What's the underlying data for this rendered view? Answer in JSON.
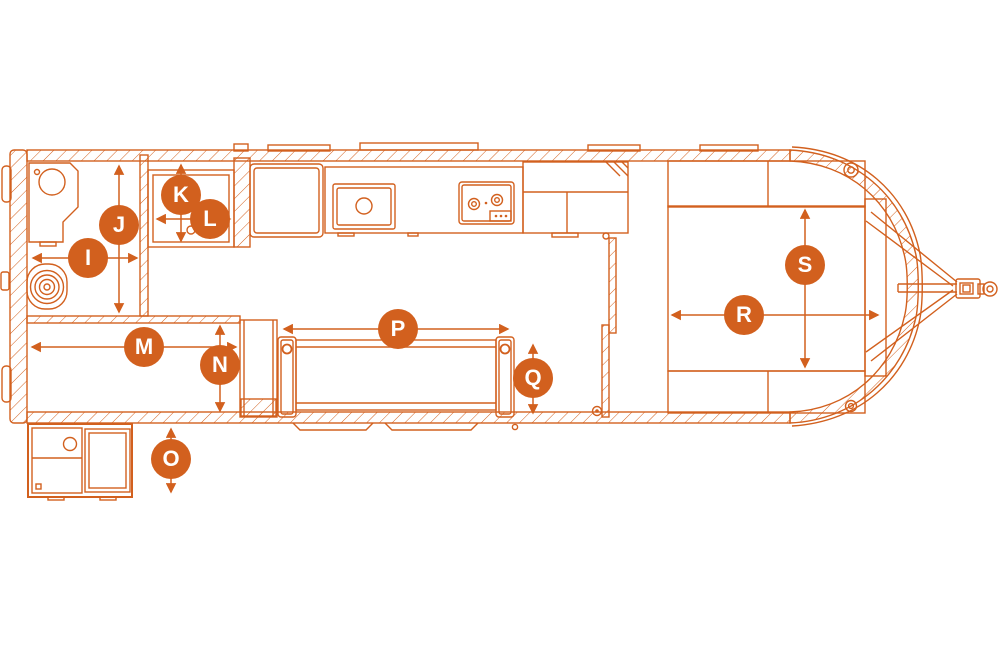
{
  "colors": {
    "accent": "#d2601e",
    "background": "#ffffff",
    "marker_letter": "#ffffff"
  },
  "markers": [
    {
      "letter": "I",
      "region": "bathroom",
      "orientation": "horizontal"
    },
    {
      "letter": "J",
      "region": "bathroom",
      "orientation": "vertical"
    },
    {
      "letter": "K",
      "region": "shower",
      "orientation": "vertical"
    },
    {
      "letter": "L",
      "region": "shower",
      "orientation": "horizontal"
    },
    {
      "letter": "M",
      "region": "rear-lounge",
      "orientation": "horizontal"
    },
    {
      "letter": "N",
      "region": "rear-lounge",
      "orientation": "vertical"
    },
    {
      "letter": "O",
      "region": "exterior-storage-box",
      "orientation": "vertical"
    },
    {
      "letter": "P",
      "region": "sofa",
      "orientation": "horizontal"
    },
    {
      "letter": "Q",
      "region": "sofa",
      "orientation": "vertical"
    },
    {
      "letter": "R",
      "region": "bed",
      "orientation": "horizontal"
    },
    {
      "letter": "S",
      "region": "bed",
      "orientation": "vertical"
    }
  ],
  "fixtures": [
    "toilet-icon",
    "vanity-sink-icon",
    "shower-pan-icon",
    "refrigerator-icon",
    "kitchen-sink-icon",
    "cooktop-icon",
    "pantry-cabinet-icon",
    "sofa-icon",
    "bed-icon",
    "nightstand-cabinet-icon",
    "exterior-storage-box-icon",
    "hitch-coupler-icon"
  ]
}
